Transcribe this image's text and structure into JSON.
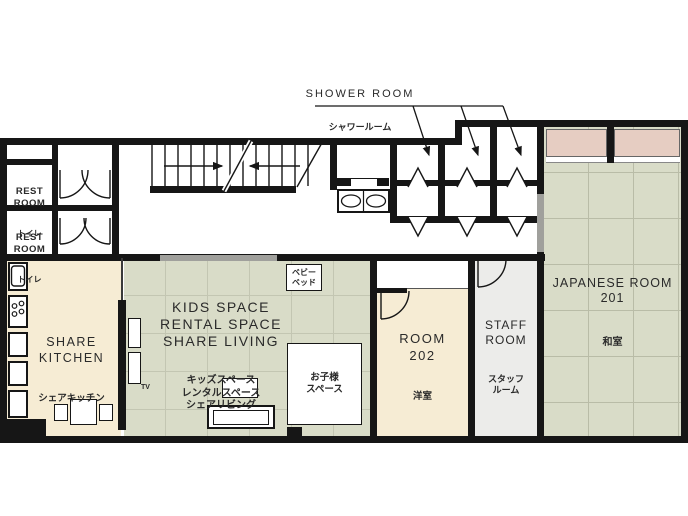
{
  "plan_title": "2F floor plan",
  "palette": {
    "wall": "#161616",
    "room_beige": "#f6ecd4",
    "tatami_green": "#d9dcc8",
    "tatami_line": "#bcbfaa",
    "closet_pink": "#e6cdc2",
    "staff_gray": "#ececea",
    "sliding_door_gray": "#a0a09c",
    "text": "#222222"
  },
  "labels": {
    "shower_room": {
      "en": "SHOWER ROOM",
      "ja": "シャワールーム"
    },
    "rest_rooms": [
      {
        "en": "REST\nROOM",
        "ja": "トイレ"
      },
      {
        "en": "REST\nROOM",
        "ja": "トイレ"
      }
    ],
    "share_kitchen": {
      "en": "SHARE\nKITCHEN",
      "ja": "シェアキッチン"
    },
    "share_living": {
      "en": "KIDS SPACE\nRENTAL SPACE\nSHARE LIVING",
      "ja": "キッズスペース\nレンタルスペース\nシェアリビング"
    },
    "baby_bed": {
      "ja": "ベビー\nベッド"
    },
    "kids_corner": {
      "ja": "お子様\nスペース"
    },
    "tv": "TV",
    "room_202": {
      "en": "ROOM\n202",
      "ja": "洋室"
    },
    "staff_room": {
      "en": "STAFF\nROOM",
      "ja": "スタッフ\nルーム"
    },
    "japanese_room": {
      "en": "JAPANESE ROOM\n201",
      "ja": "和室"
    }
  }
}
